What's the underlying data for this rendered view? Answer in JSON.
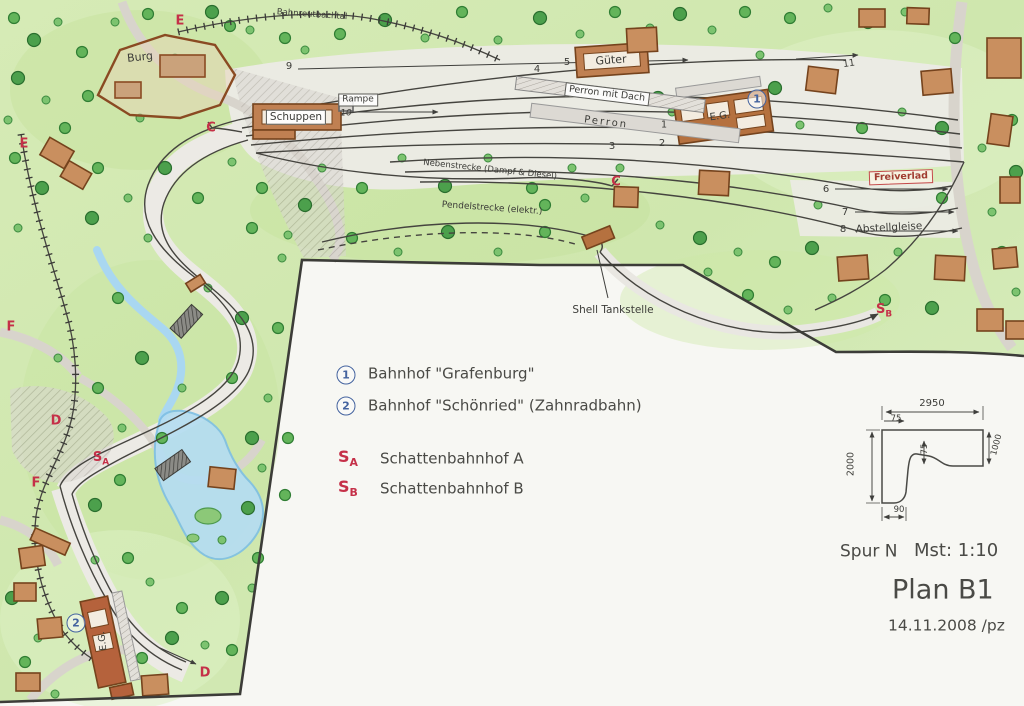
{
  "labels": {
    "burg": "Burg",
    "valley": "Bahnreutbachtal",
    "gueter": "Güter",
    "schuppen": "Schuppen",
    "rampe": "Rampe",
    "perron_dach": "Perron mit Dach",
    "perron": "Perron",
    "eg": "E.G.",
    "freiverlad": "Freiverlad",
    "abstellgleise": "Abstellgleise",
    "nebenstrecke": "Nebenstrecke (Dampf & Diesel)",
    "pendelstrecke": "Pendelstrecke (elektr.)",
    "shell": "Shell Tankstelle"
  },
  "markers": {
    "e": "E",
    "c": "C",
    "f": "F",
    "d": "D",
    "s": "S",
    "a": "A",
    "b": "B"
  },
  "circled": {
    "one": "1",
    "two": "2"
  },
  "tracks": {
    "n1": "1",
    "n2": "2",
    "n3": "3",
    "n4": "4",
    "n5": "5",
    "n6": "6",
    "n7": "7",
    "n8": "8",
    "n9": "9",
    "n10": "10",
    "n11": "11"
  },
  "legend": {
    "station1": "Bahnhof \"Grafenburg\"",
    "station2": "Bahnhof \"Schönried\" (Zahnradbahn)",
    "shadow_a": "Schattenbahnhof A",
    "shadow_b": "Schattenbahnhof B"
  },
  "footer": {
    "gauge": "Spur N",
    "scale": "Mst: 1:10",
    "plan": "Plan B1",
    "date": "14.11.2008 /pz"
  },
  "dimensions": {
    "top": "2950",
    "top_left": "75",
    "left": "2000",
    "inner": "75",
    "right": "1000",
    "bottom": "90"
  }
}
